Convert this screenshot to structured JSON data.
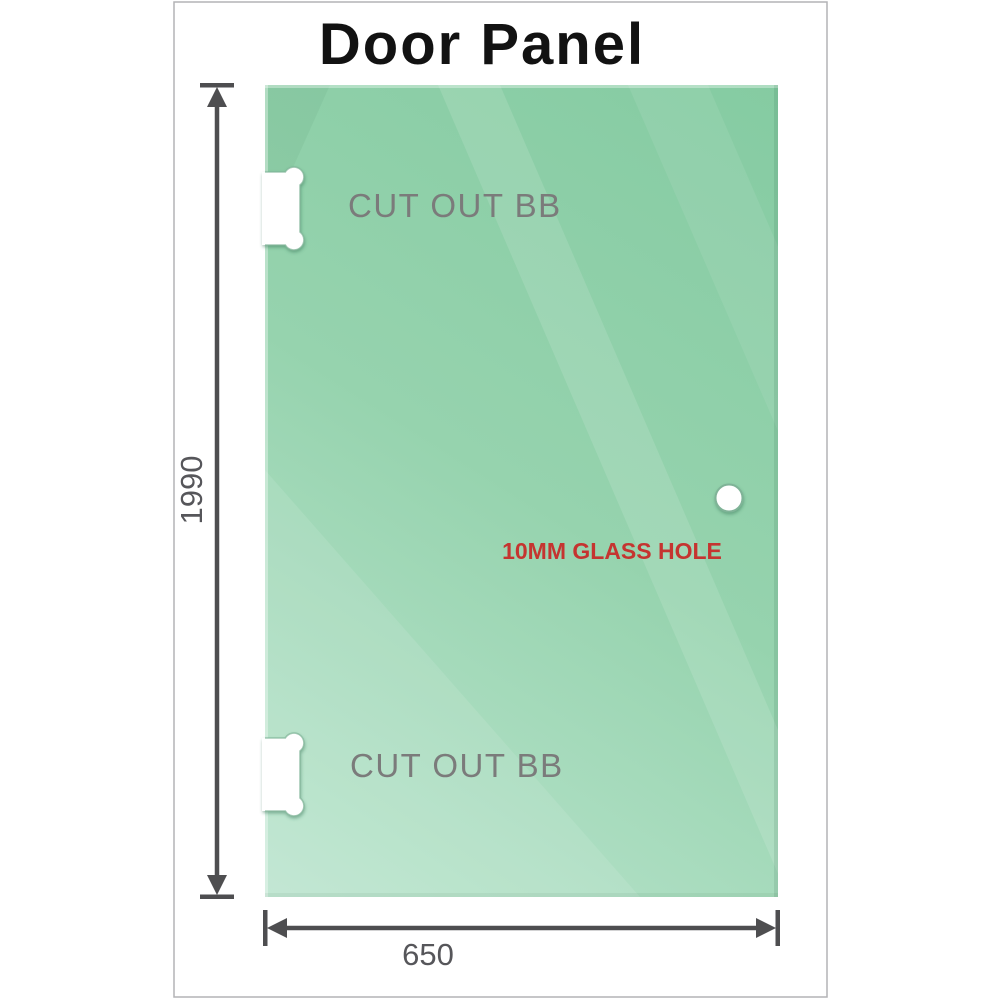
{
  "title": "Door Panel",
  "frame": {
    "border_color": "#b3b3b6",
    "background_color": "#ffffff"
  },
  "panel": {
    "glass_color_dark": "#85cba2",
    "glass_color_mid": "#96d3ae",
    "glass_color_light": "#bce5cf"
  },
  "annotations": {
    "cutout_top_label": "CUT OUT BB",
    "cutout_bottom_label": "CUT OUT BB",
    "glass_hole_label": "10MM GLASS HOLE",
    "cutout_label_color": "#7b7b7b",
    "glass_hole_label_color": "#c53430"
  },
  "dimensions": {
    "height": "1990",
    "width": "650",
    "line_color": "#4e4e50",
    "text_color": "#56565a"
  }
}
